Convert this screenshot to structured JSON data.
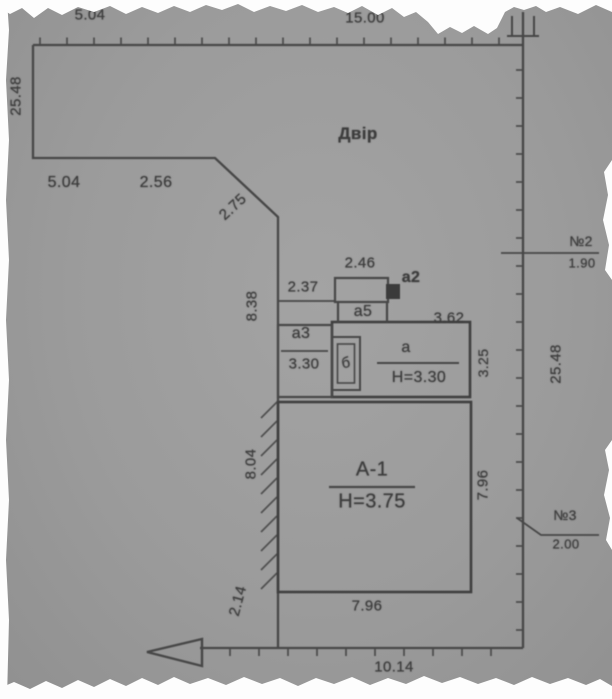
{
  "plan": {
    "title_area_label": "Двір",
    "colors": {
      "paper": "#9c9c9c",
      "ink": "#474747",
      "text": "#3d3d3d",
      "torn_edge": "#fdfdfd"
    },
    "neighbors": [
      {
        "marker": "№2",
        "dimension": "1.90"
      },
      {
        "marker": "№3",
        "dimension": "2.00"
      }
    ],
    "buildings": [
      {
        "id": "А-1",
        "height": "H=3.75"
      },
      {
        "id": "а",
        "height": "H=3.30"
      },
      {
        "id": "а2"
      },
      {
        "id": "а3",
        "dimension": "3.30"
      },
      {
        "id": "а5"
      },
      {
        "id": "б"
      }
    ],
    "labels": [
      {
        "name": "dim-top-left-5-04",
        "text": "5.04",
        "x": 90,
        "y": 15,
        "rot": 0,
        "size": 15
      },
      {
        "name": "dim-top-right-15-00",
        "text": "15.00",
        "x": 365,
        "y": 18,
        "rot": 0,
        "size": 15
      },
      {
        "name": "dim-left-25-48",
        "text": "25.48",
        "x": 16,
        "y": 96,
        "rot": -90,
        "size": 15
      },
      {
        "name": "yard-label",
        "text": "Двір",
        "x": 358,
        "y": 134,
        "rot": 0,
        "size": 17,
        "bold": true
      },
      {
        "name": "dim-notch-5-04",
        "text": "5.04",
        "x": 64,
        "y": 183,
        "rot": 0,
        "size": 16
      },
      {
        "name": "dim-notch-2-56",
        "text": "2.56",
        "x": 156,
        "y": 183,
        "rot": 0,
        "size": 16
      },
      {
        "name": "dim-diagonal-2-75",
        "text": "2.75",
        "x": 233,
        "y": 207,
        "rot": -43,
        "size": 15
      },
      {
        "name": "dim-left-8-38",
        "text": "8.38",
        "x": 252,
        "y": 306,
        "rot": -90,
        "size": 15
      },
      {
        "name": "dim-a5-width-2-46",
        "text": "2.46",
        "x": 360,
        "y": 263,
        "rot": 0,
        "size": 15
      },
      {
        "name": "building-label-a2",
        "text": "а2",
        "x": 411,
        "y": 278,
        "rot": 0,
        "size": 16,
        "bold": true
      },
      {
        "name": "dim-2-37",
        "text": "2.37",
        "x": 303,
        "y": 287,
        "rot": 0,
        "size": 15
      },
      {
        "name": "building-label-a5",
        "text": "а5",
        "x": 363,
        "y": 312,
        "rot": 0,
        "size": 16
      },
      {
        "name": "dim-a-top-3-62",
        "text": "3.62",
        "x": 449,
        "y": 318,
        "rot": 0,
        "size": 15
      },
      {
        "name": "building-label-a3",
        "text": "а3",
        "x": 301,
        "y": 334,
        "rot": 0,
        "size": 16
      },
      {
        "name": "dim-a3-3-30",
        "text": "3.30",
        "x": 304,
        "y": 364,
        "rot": 0,
        "size": 15
      },
      {
        "name": "building-label-b",
        "text": "б",
        "x": 346,
        "y": 363,
        "rot": -10,
        "size": 15
      },
      {
        "name": "building-label-a",
        "text": "а",
        "x": 406,
        "y": 348,
        "rot": 0,
        "size": 16
      },
      {
        "name": "height-a",
        "text": "H=3.30",
        "x": 419,
        "y": 378,
        "rot": 0,
        "size": 16
      },
      {
        "name": "dim-a-right-3-25",
        "text": "3.25",
        "x": 483,
        "y": 363,
        "rot": -90,
        "size": 14
      },
      {
        "name": "dim-right-25-48",
        "text": "25.48",
        "x": 556,
        "y": 364,
        "rot": -90,
        "size": 15
      },
      {
        "name": "neighbor-2-marker",
        "text": "№2",
        "x": 581,
        "y": 241,
        "rot": 0,
        "size": 14
      },
      {
        "name": "neighbor-2-dim-1-90",
        "text": "1.90",
        "x": 582,
        "y": 263,
        "rot": 0,
        "size": 13
      },
      {
        "name": "building-label-A-1",
        "text": "А-1",
        "x": 372,
        "y": 470,
        "rot": 0,
        "size": 20
      },
      {
        "name": "height-A-1",
        "text": "H=3.75",
        "x": 372,
        "y": 502,
        "rot": 0,
        "size": 20
      },
      {
        "name": "dim-A1-right-7-96",
        "text": "7.96",
        "x": 483,
        "y": 485,
        "rot": -90,
        "size": 15
      },
      {
        "name": "neighbor-3-marker",
        "text": "№3",
        "x": 565,
        "y": 515,
        "rot": 0,
        "size": 14
      },
      {
        "name": "neighbor-3-dim-2-00",
        "text": "2.00",
        "x": 566,
        "y": 544,
        "rot": 0,
        "size": 13
      },
      {
        "name": "dim-A1-left-8-04",
        "text": "8.04",
        "x": 251,
        "y": 464,
        "rot": -90,
        "size": 15
      },
      {
        "name": "dim-2-14",
        "text": "2.14",
        "x": 238,
        "y": 601,
        "rot": -75,
        "size": 15
      },
      {
        "name": "dim-A1-bottom-7-96",
        "text": "7.96",
        "x": 367,
        "y": 606,
        "rot": 0,
        "size": 15
      },
      {
        "name": "dim-bottom-10-14",
        "text": "10.14",
        "x": 394,
        "y": 667,
        "rot": 0,
        "size": 15
      }
    ]
  }
}
